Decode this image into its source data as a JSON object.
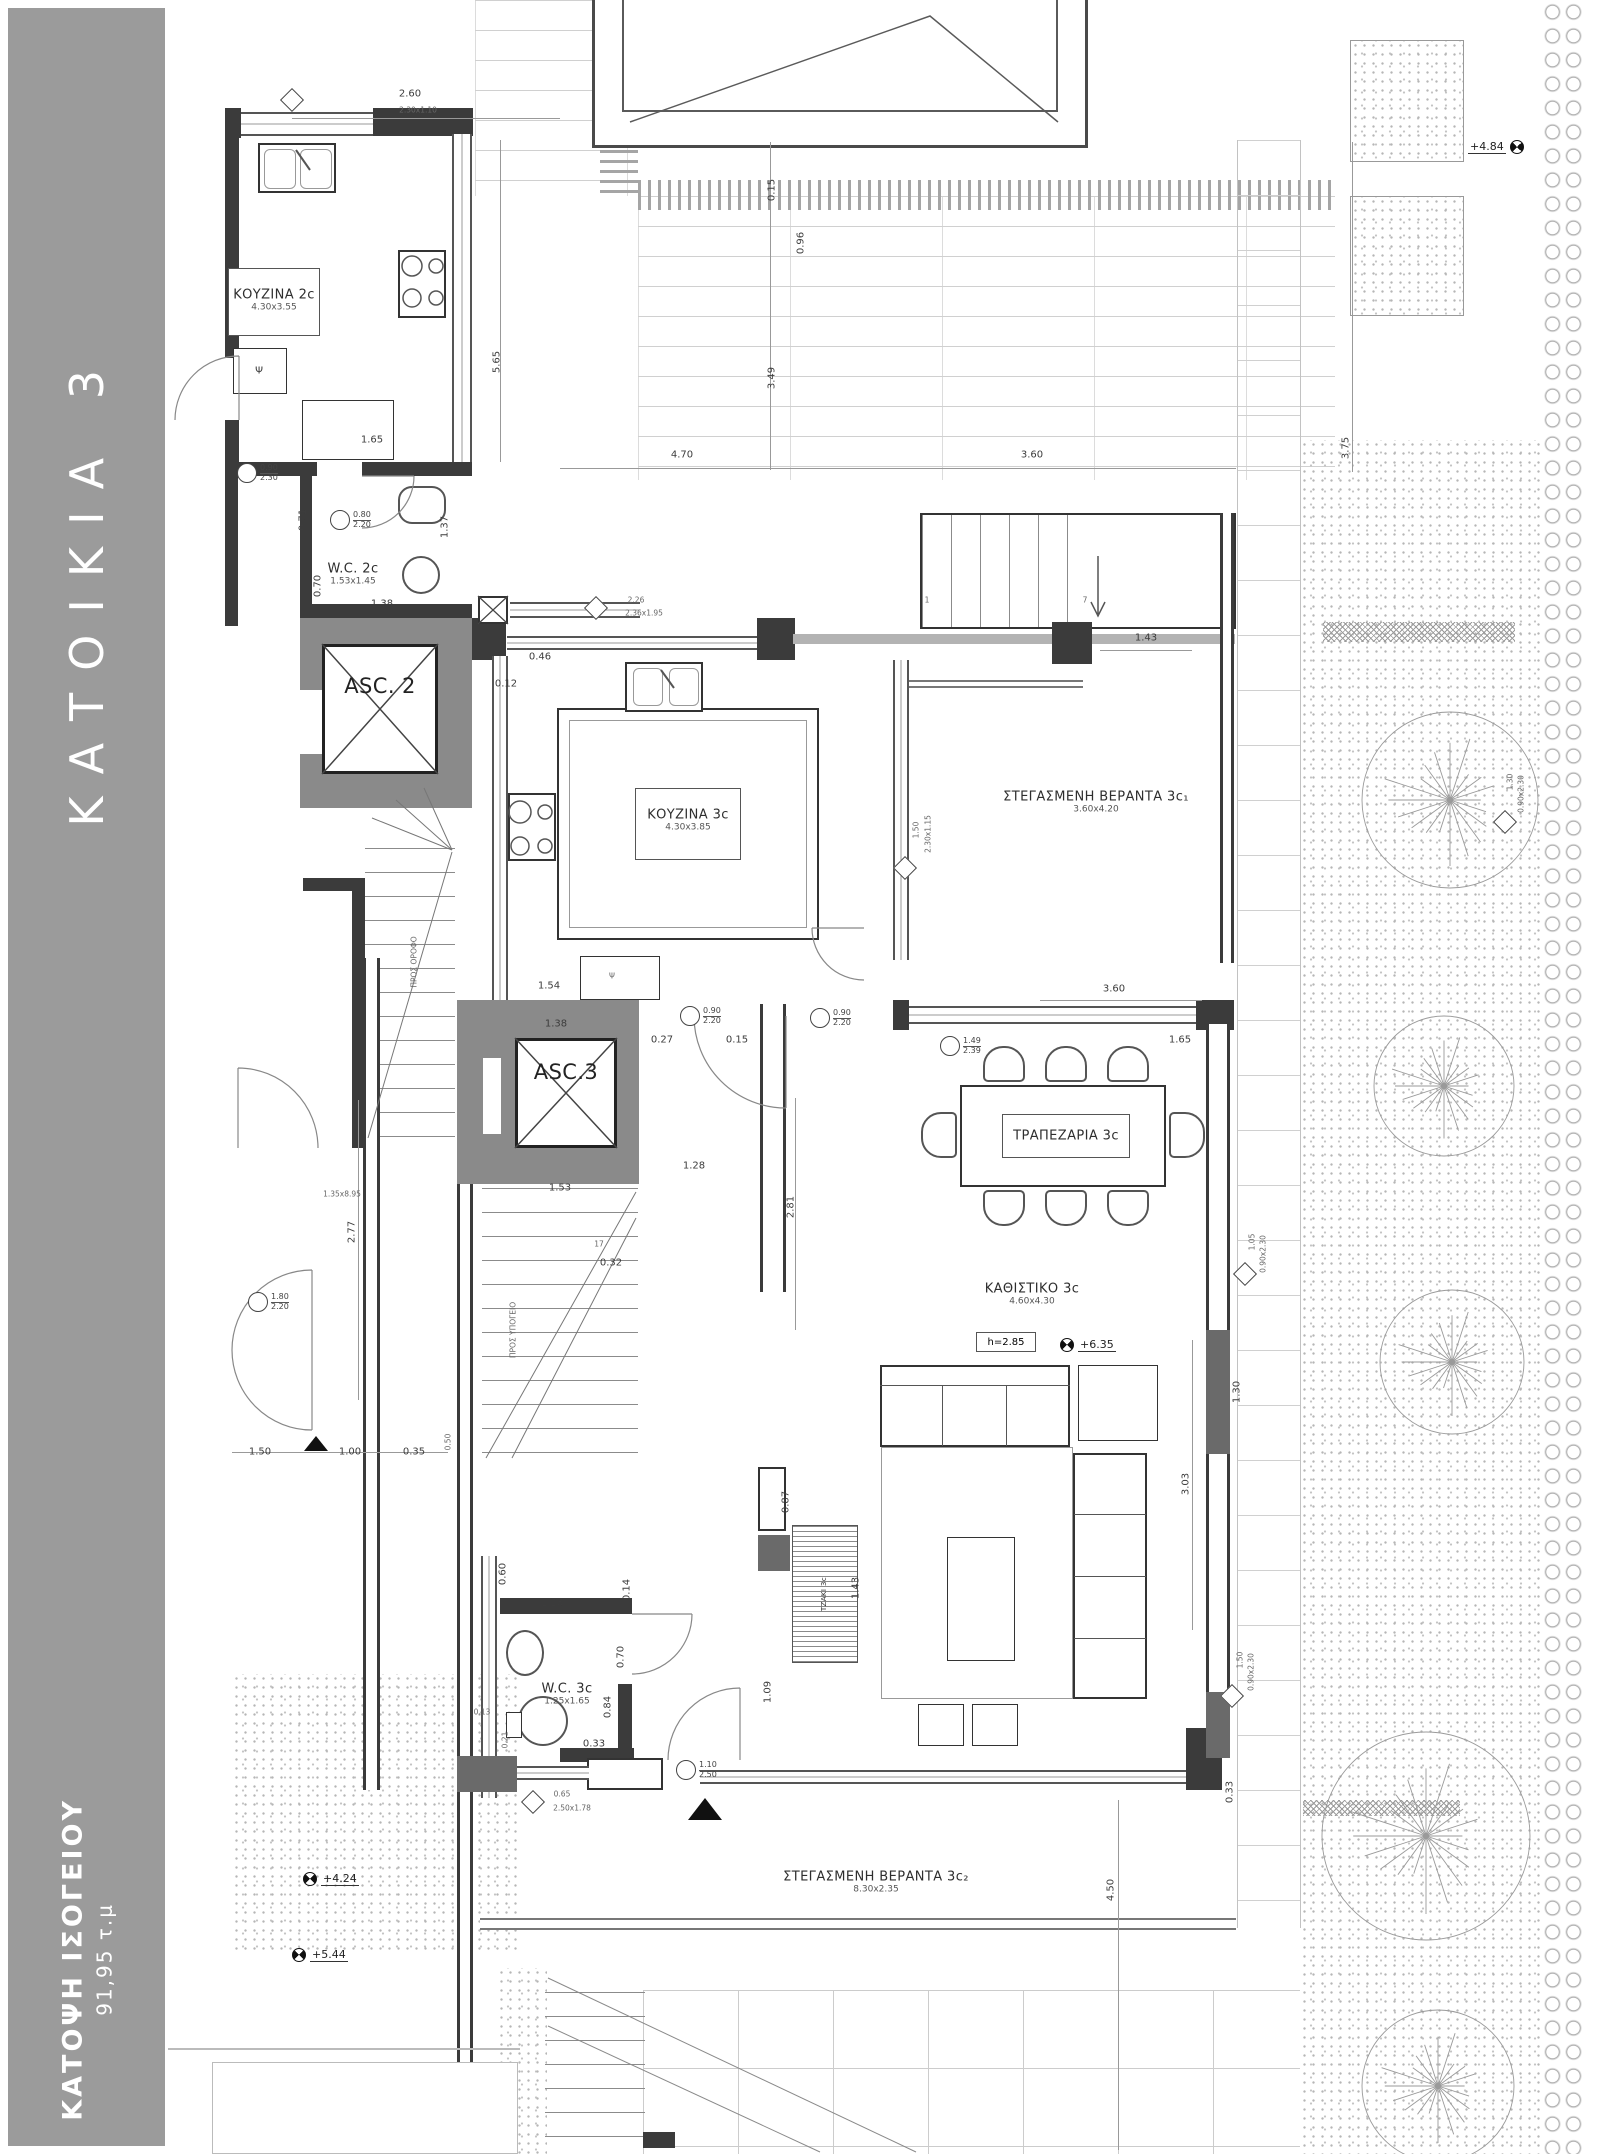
{
  "sidebar": {
    "title": "ΚΑΤΟΙΚΙΑ 3",
    "plan_name": "ΚΑΤΟΨΗ ΙΣΟΓΕΙΟΥ",
    "area": "91,95 τ.μ"
  },
  "palette": {
    "sidebar_gray": "#9b9b9b",
    "wall_dark": "#3b3b3b",
    "core_gray": "#8a8a8a",
    "line_gray": "#999999"
  },
  "rooms": [
    {
      "label": "ΚΟΥΖΙΝΑ 2c",
      "size": "4.30x3.55",
      "x": 274,
      "y": 300,
      "box": [
        228,
        268,
        92,
        68
      ]
    },
    {
      "label": "W.C. 2c",
      "size": "1.53x1.45",
      "x": 353,
      "y": 574
    },
    {
      "label": "ASC. 2",
      "x": 380,
      "y": 686,
      "cls": "big"
    },
    {
      "label": "ASC.3",
      "x": 566,
      "y": 1072,
      "cls": "big"
    },
    {
      "label": "ΚΟΥΖΙΝΑ 3c",
      "size": "4.30x3.85",
      "x": 688,
      "y": 820,
      "box": [
        635,
        788,
        106,
        72
      ]
    },
    {
      "label": "ΣΤΕΓΑΣΜΕΝΗ ΒΕΡΑΝΤΑ 3c₁",
      "size": "3.60x4.20",
      "x": 1096,
      "y": 802
    },
    {
      "label": "ΤΡΑΠΕΖΑΡΙΑ 3c",
      "x": 1066,
      "y": 1136,
      "box": [
        1002,
        1114,
        128,
        44
      ]
    },
    {
      "label": "ΚΑΘΙΣΤΙΚΟ 3c",
      "size": "4.60x4.30",
      "x": 1032,
      "y": 1294
    },
    {
      "label": "W.C. 3c",
      "size": "1.25x1.65",
      "x": 567,
      "y": 1694
    },
    {
      "label": "ΣΤΕΓΑΣΜΕΝΗ ΒΕΡΑΝΤΑ 3c₂",
      "size": "8.30x2.35",
      "x": 876,
      "y": 1882
    },
    {
      "label": "ΤΖΑΚΙ 3c",
      "x": 824,
      "y": 1594,
      "cls": "micro",
      "r": -90
    }
  ],
  "annotations": {
    "boxed": [
      {
        "t": "h=2.85",
        "x": 976,
        "y": 1332,
        "w": 60,
        "h": 20
      }
    ],
    "dims": [
      {
        "t": "2.60",
        "x": 410,
        "y": 94
      },
      {
        "t": "2.30x1.10",
        "x": 418,
        "y": 110,
        "cls": "micro"
      },
      {
        "t": "5.65",
        "x": 497,
        "y": 362,
        "r": -90
      },
      {
        "t": "1.65",
        "x": 372,
        "y": 440
      },
      {
        "t": "4.70",
        "x": 682,
        "y": 455
      },
      {
        "t": "3.60",
        "x": 1032,
        "y": 455
      },
      {
        "t": "0.15",
        "x": 772,
        "y": 190,
        "r": -90
      },
      {
        "t": "0.96",
        "x": 801,
        "y": 243,
        "r": -90
      },
      {
        "t": "3.49",
        "x": 772,
        "y": 378,
        "r": -90
      },
      {
        "t": "3.75",
        "x": 1346,
        "y": 448,
        "r": -90
      },
      {
        "t": "0.71",
        "x": 303,
        "y": 520,
        "r": -90
      },
      {
        "t": "1.37",
        "x": 445,
        "y": 527,
        "r": -90
      },
      {
        "t": "1.38",
        "x": 382,
        "y": 604
      },
      {
        "t": "0.70",
        "x": 318,
        "y": 586,
        "r": -90
      },
      {
        "t": "0.46",
        "x": 540,
        "y": 657
      },
      {
        "t": "0.12",
        "x": 506,
        "y": 684
      },
      {
        "t": "1.43",
        "x": 1146,
        "y": 638
      },
      {
        "t": "1.54",
        "x": 549,
        "y": 986
      },
      {
        "t": "1.38",
        "x": 556,
        "y": 1024
      },
      {
        "t": "0.27",
        "x": 662,
        "y": 1040
      },
      {
        "t": "0.15",
        "x": 737,
        "y": 1040
      },
      {
        "t": "1.28",
        "x": 694,
        "y": 1166
      },
      {
        "t": "2.81",
        "x": 791,
        "y": 1207,
        "r": -90
      },
      {
        "t": "1.53",
        "x": 560,
        "y": 1188
      },
      {
        "t": "0.32",
        "x": 611,
        "y": 1263
      },
      {
        "t": "3.60",
        "x": 1114,
        "y": 989
      },
      {
        "t": "1.65",
        "x": 1180,
        "y": 1040
      },
      {
        "t": "3.03",
        "x": 1186,
        "y": 1484,
        "r": -90
      },
      {
        "t": "1.30",
        "x": 1237,
        "y": 1392,
        "r": -90
      },
      {
        "t": "2.77",
        "x": 352,
        "y": 1232,
        "r": -90
      },
      {
        "t": "1.50",
        "x": 260,
        "y": 1452
      },
      {
        "t": "1.00",
        "x": 350,
        "y": 1452
      },
      {
        "t": "0.35",
        "x": 414,
        "y": 1452
      },
      {
        "t": "0.50",
        "x": 448,
        "y": 1442,
        "r": -90,
        "cls": "micro"
      },
      {
        "t": "0.87",
        "x": 786,
        "y": 1502,
        "r": -90
      },
      {
        "t": "1.43",
        "x": 856,
        "y": 1588,
        "r": -90
      },
      {
        "t": "1.09",
        "x": 768,
        "y": 1692,
        "r": -90
      },
      {
        "t": "0.60",
        "x": 503,
        "y": 1574,
        "r": -90
      },
      {
        "t": "0.14",
        "x": 627,
        "y": 1590,
        "r": -90
      },
      {
        "t": "1.28",
        "x": 552,
        "y": 1603
      },
      {
        "t": "0.70",
        "x": 621,
        "y": 1657,
        "r": -90
      },
      {
        "t": "0.84",
        "x": 608,
        "y": 1707,
        "r": -90
      },
      {
        "t": "0.33",
        "x": 594,
        "y": 1744
      },
      {
        "t": "0.21",
        "x": 505,
        "y": 1740,
        "r": -90,
        "cls": "micro"
      },
      {
        "t": "0.13",
        "x": 482,
        "y": 1712,
        "cls": "micro"
      },
      {
        "t": "4.50",
        "x": 1111,
        "y": 1890,
        "r": -90
      },
      {
        "t": "0.33",
        "x": 1230,
        "y": 1792,
        "r": -90
      },
      {
        "t": "1.35x8.95",
        "x": 342,
        "y": 1194,
        "cls": "micro"
      },
      {
        "t": "17",
        "x": 599,
        "y": 1244,
        "cls": "micro"
      },
      {
        "t": "2.26",
        "x": 636,
        "y": 600,
        "cls": "micro"
      },
      {
        "t": "2.36x1.95",
        "x": 644,
        "y": 613,
        "cls": "micro"
      },
      {
        "t": "1.50",
        "x": 916,
        "y": 830,
        "r": -90,
        "cls": "micro"
      },
      {
        "t": "2.30x1.15",
        "x": 928,
        "y": 834,
        "r": -90,
        "cls": "micro"
      },
      {
        "t": "0.65",
        "x": 562,
        "y": 1794,
        "cls": "micro"
      },
      {
        "t": "2.50x1.78",
        "x": 572,
        "y": 1808,
        "cls": "micro"
      },
      {
        "t": "1.05",
        "x": 1252,
        "y": 1242,
        "r": -90,
        "cls": "micro"
      },
      {
        "t": "0.90x2.30",
        "x": 1263,
        "y": 1254,
        "r": -90,
        "cls": "micro"
      },
      {
        "t": "1.50",
        "x": 1240,
        "y": 1660,
        "r": -90,
        "cls": "micro"
      },
      {
        "t": "0.90x2.30",
        "x": 1251,
        "y": 1672,
        "r": -90,
        "cls": "micro"
      },
      {
        "t": "1.30",
        "x": 1510,
        "y": 782,
        "r": -90,
        "cls": "micro"
      },
      {
        "t": "0.90x2.30",
        "x": 1521,
        "y": 794,
        "r": -90,
        "cls": "micro"
      },
      {
        "t": "Ψ",
        "x": 259,
        "y": 371
      },
      {
        "t": "Ψ",
        "x": 612,
        "y": 976,
        "cls": "micro"
      },
      {
        "t": "ΠΡΟΣ ΟΡΟΦΟ",
        "x": 414,
        "y": 962,
        "r": -90,
        "cls": "micro"
      },
      {
        "t": "ΠΡΟΣ ΥΠΟΓΕΙΟ",
        "x": 513,
        "y": 1330,
        "r": -90,
        "cls": "micro"
      },
      {
        "t": "1",
        "x": 927,
        "y": 600,
        "cls": "micro"
      },
      {
        "t": "7",
        "x": 1085,
        "y": 600,
        "cls": "micro"
      }
    ],
    "diamond_markers": [
      {
        "x": 292,
        "y": 100
      },
      {
        "x": 596,
        "y": 608
      },
      {
        "x": 905,
        "y": 868
      },
      {
        "x": 533,
        "y": 1802
      },
      {
        "x": 1245,
        "y": 1274
      },
      {
        "x": 1232,
        "y": 1696
      },
      {
        "x": 1505,
        "y": 822
      }
    ],
    "circle_markers": [
      {
        "x": 247,
        "y": 473,
        "top": "0.90",
        "bottom": "2.30"
      },
      {
        "x": 340,
        "y": 520,
        "top": "0.80",
        "bottom": "2.20"
      },
      {
        "x": 690,
        "y": 1016,
        "top": "0.90",
        "bottom": "2.20"
      },
      {
        "x": 820,
        "y": 1018,
        "top": "0.90",
        "bottom": "2.20"
      },
      {
        "x": 950,
        "y": 1046,
        "top": "1.49",
        "bottom": "2.39"
      },
      {
        "x": 686,
        "y": 1770,
        "top": "1.10",
        "bottom": "2.50"
      },
      {
        "x": 258,
        "y": 1302,
        "top": "1.80",
        "bottom": "2.20"
      }
    ],
    "level_markers": [
      {
        "t": "+4.84",
        "x": 1468,
        "y": 140,
        "side": "right"
      },
      {
        "t": "+4.24",
        "x": 303,
        "y": 1872,
        "side": "left"
      },
      {
        "t": "+5.44",
        "x": 292,
        "y": 1948,
        "side": "left"
      },
      {
        "t": "+6.35",
        "x": 1060,
        "y": 1338,
        "side": "left"
      }
    ]
  },
  "site": {
    "trees": [
      {
        "x": 1450,
        "y": 800,
        "r": 88
      },
      {
        "x": 1444,
        "y": 1086,
        "r": 70
      },
      {
        "x": 1452,
        "y": 1362,
        "r": 72
      },
      {
        "x": 1426,
        "y": 1836,
        "r": 104
      },
      {
        "x": 1438,
        "y": 2086,
        "r": 76
      }
    ]
  }
}
